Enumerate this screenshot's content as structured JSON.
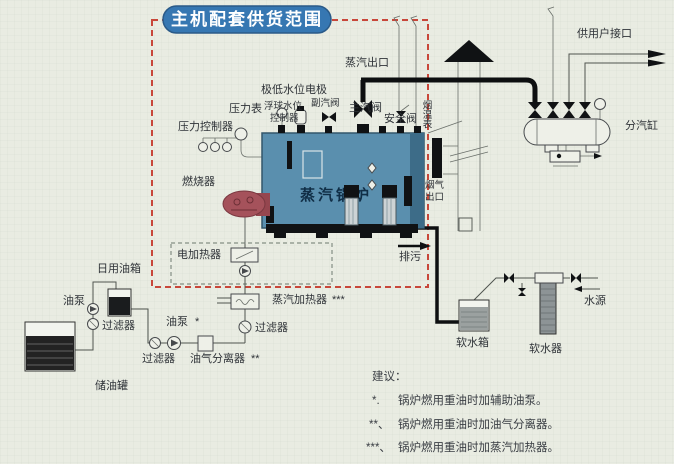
{
  "title": "主机配套供货范围",
  "labels": {
    "steam_outlet": "蒸汽出口",
    "low_water_electrode": "极低水位电极",
    "pressure_gauge": "压力表",
    "float_controller_line1": "浮球水位",
    "float_controller_line2": "控制器",
    "aux_steam_valve": "副汽阀",
    "main_steam_valve": "主汽阀",
    "safety_valve": "安全阀",
    "flue_temp_gauge": "烟温表",
    "pressure_controller": "压力控制器",
    "burner": "燃烧器",
    "boiler": "蒸汽锅炉",
    "flue_outlet_line1": "烟气",
    "flue_outlet_line2": "出口",
    "user_port": "供用户接口",
    "steam_cylinder": "分汽缸",
    "blowdown": "排污",
    "electric_heater": "电加热器",
    "steam_heater": "蒸汽加热器",
    "steam_heater_marker": "***",
    "daily_oil_tank": "日用油箱",
    "oil_pump": "油泵",
    "oil_pump_aux": "油泵",
    "oil_pump_aux_marker": "*",
    "filter_a": "过滤器",
    "filter_b": "过滤器",
    "filter_c": "过滤器",
    "oil_gas_separator": "油气分离器",
    "oil_gas_separator_marker": "**",
    "oil_storage_tank": "储油罐",
    "soft_water_tank": "软水箱",
    "water_softener": "软水器",
    "water_source": "水源"
  },
  "notes": {
    "heading": "建议：",
    "items": [
      {
        "marker": "*.",
        "text": "锅炉燃用重油时加辅助油泵。"
      },
      {
        "marker": "**、",
        "text": "锅炉燃用重油时加油气分离器。"
      },
      {
        "marker": "***、",
        "text": "锅炉燃用重油时加蒸汽加热器。"
      }
    ]
  },
  "colors": {
    "paper": "#e9ece2",
    "scope_border": "#c8473a",
    "title_bg": "#3677b2",
    "boiler_fill": "#5a8fae",
    "boiler_edge": "#3d6c88",
    "burner_fill": "#a5525b"
  }
}
